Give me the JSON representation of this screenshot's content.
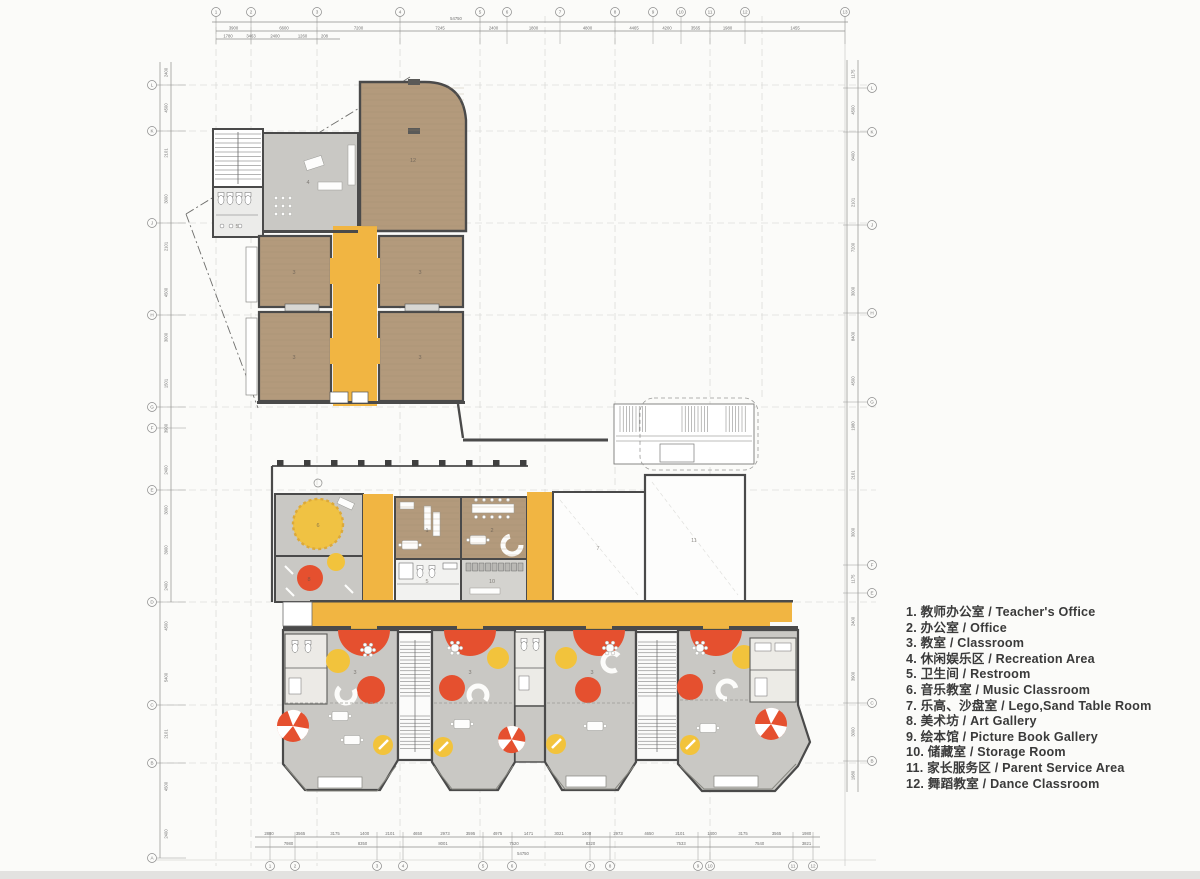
{
  "title": "Kindergarten Floor Plan",
  "colors": {
    "wall": "#4a4a4a",
    "wood": "#b39a7c",
    "gray_room": "#c9c8c4",
    "corridor_yellow": "#f1b542",
    "accent_red": "#e5502f",
    "accent_yellow": "#f2c33c",
    "dim_line": "#8a8a8a",
    "grid_line": "#cfcfcc",
    "legend_text": "#3a3a3a"
  },
  "legend": {
    "items": [
      "1. 教师办公室 / Teacher's Office",
      "2. 办公室 / Office",
      "3. 教室 / Classroom",
      "4. 休闲娱乐区 / Recreation Area",
      "5. 卫生间 / Restroom",
      "6. 音乐教室 / Music Classroom",
      "7. 乐高、沙盘室 / Lego,Sand Table Room",
      "8. 美术坊 / Art Gallery",
      "9. 绘本馆 / Picture Book Gallery",
      "10. 储藏室 / Storage Room",
      "11. 家长服务区 / Parent Service Area",
      "12. 舞蹈教室 / Dance Classroom"
    ]
  },
  "rooms": {
    "dance": {
      "label": "12"
    },
    "recreation": {
      "label": "4"
    },
    "restroom_upper": {
      "label": "5"
    },
    "classroom_tl": {
      "label": "3"
    },
    "classroom_tr": {
      "label": "3"
    },
    "classroom_bl": {
      "label": "3"
    },
    "classroom_br": {
      "label": "3"
    },
    "music": {
      "label": "6"
    },
    "art": {
      "label": "8"
    },
    "office1": {
      "label": "1"
    },
    "office2": {
      "label": "2"
    },
    "restroom_mid": {
      "label": "5"
    },
    "storage": {
      "label": "10"
    },
    "lego": {
      "label": "7"
    },
    "parent": {
      "label": "11"
    },
    "classroom_a": {
      "label": "3"
    },
    "classroom_b": {
      "label": "3"
    },
    "classroom_c": {
      "label": "3"
    },
    "classroom_d": {
      "label": "3"
    }
  },
  "dims": {
    "top_total": "54750",
    "bottom_total": "54750",
    "top_main": [
      "3900",
      "6600",
      "7200",
      "7245",
      "2400",
      "1800",
      "4800",
      "4465",
      "4200",
      "3565",
      "1980",
      "1455"
    ],
    "top_sub": [
      "1780",
      "3463",
      "2400",
      "1260",
      "208"
    ],
    "bottom_seg": [
      "2880",
      "3565",
      "3175",
      "1400",
      "2101",
      "4650",
      "2973",
      "3595",
      "4975",
      "1471",
      "3021",
      "1400",
      "2973",
      "4650",
      "2101",
      "1400",
      "3175",
      "3565",
      "1980"
    ],
    "bottom_span": [
      "7980",
      "8350",
      "8001",
      "7520",
      "8320",
      "7533",
      "7540",
      "3821"
    ],
    "left": [
      "2400",
      "4500",
      "2101",
      "3000",
      "2101",
      "4500",
      "3000",
      "1501",
      "3900",
      "2400",
      "3000",
      "3900",
      "2400",
      "4500",
      "5400",
      "2101",
      "4500",
      "2400"
    ],
    "right": [
      "1175",
      "4500",
      "8400",
      "2101",
      "7200",
      "3000",
      "8400",
      "4500",
      "1980",
      "2101",
      "3000",
      "1175",
      "2400",
      "3900",
      "3000",
      "1980"
    ]
  },
  "grid": {
    "top_bubbles": [
      {
        "x": 216,
        "label": "1"
      },
      {
        "x": 251,
        "label": "2"
      },
      {
        "x": 317,
        "label": "3"
      },
      {
        "x": 400,
        "label": "4"
      },
      {
        "x": 480,
        "label": "5"
      },
      {
        "x": 507,
        "label": "6"
      },
      {
        "x": 560,
        "label": "7"
      },
      {
        "x": 615,
        "label": "8"
      },
      {
        "x": 653,
        "label": "9"
      },
      {
        "x": 681,
        "label": "10"
      },
      {
        "x": 710,
        "label": "11"
      },
      {
        "x": 745,
        "label": "12"
      },
      {
        "x": 845,
        "label": "13"
      }
    ],
    "top_sub_x": [
      216,
      240,
      262,
      288,
      317,
      332
    ],
    "bottom_bubbles": [
      {
        "x": 270,
        "label": "1"
      },
      {
        "x": 295,
        "label": "2"
      },
      {
        "x": 377,
        "label": "3"
      },
      {
        "x": 403,
        "label": "4"
      },
      {
        "x": 483,
        "label": "5"
      },
      {
        "x": 512,
        "label": "6"
      },
      {
        "x": 590,
        "label": "7"
      },
      {
        "x": 610,
        "label": "8"
      },
      {
        "x": 698,
        "label": "9"
      },
      {
        "x": 710,
        "label": "10"
      },
      {
        "x": 793,
        "label": "11"
      },
      {
        "x": 813,
        "label": "12"
      }
    ],
    "bottom_seg_x": [
      255,
      283,
      318,
      352,
      377,
      403,
      432,
      458,
      483,
      512,
      545,
      573,
      600,
      636,
      662,
      698,
      726,
      760,
      793,
      820
    ],
    "bottom_span_x": [
      255,
      322,
      403,
      483,
      545,
      636,
      726,
      793,
      820
    ],
    "left_bubbles": [
      {
        "y": 85,
        "label": "L"
      },
      {
        "y": 131,
        "label": "K"
      },
      {
        "y": 223,
        "label": "J"
      },
      {
        "y": 315,
        "label": "H"
      },
      {
        "y": 407,
        "label": "G"
      },
      {
        "y": 428,
        "label": "F"
      },
      {
        "y": 490,
        "label": "E"
      },
      {
        "y": 602,
        "label": "D"
      },
      {
        "y": 705,
        "label": "C"
      },
      {
        "y": 763,
        "label": "B"
      },
      {
        "y": 858,
        "label": "A"
      }
    ],
    "left_seg_y": [
      60,
      85,
      131,
      175,
      223,
      270,
      315,
      360,
      407,
      450,
      490,
      530,
      570,
      602,
      650,
      705,
      763,
      810,
      858
    ],
    "right_bubbles": [
      {
        "y": 88,
        "label": "L"
      },
      {
        "y": 132,
        "label": "K"
      },
      {
        "y": 225,
        "label": "J"
      },
      {
        "y": 313,
        "label": "H"
      },
      {
        "y": 402,
        "label": "G"
      },
      {
        "y": 565,
        "label": "F"
      },
      {
        "y": 593,
        "label": "E"
      },
      {
        "y": 703,
        "label": "C"
      },
      {
        "y": 761,
        "label": "B"
      }
    ],
    "right_seg_y": [
      60,
      88,
      132,
      180,
      225,
      270,
      313,
      360,
      402,
      450,
      500,
      565,
      593,
      650,
      703,
      761,
      790
    ]
  }
}
